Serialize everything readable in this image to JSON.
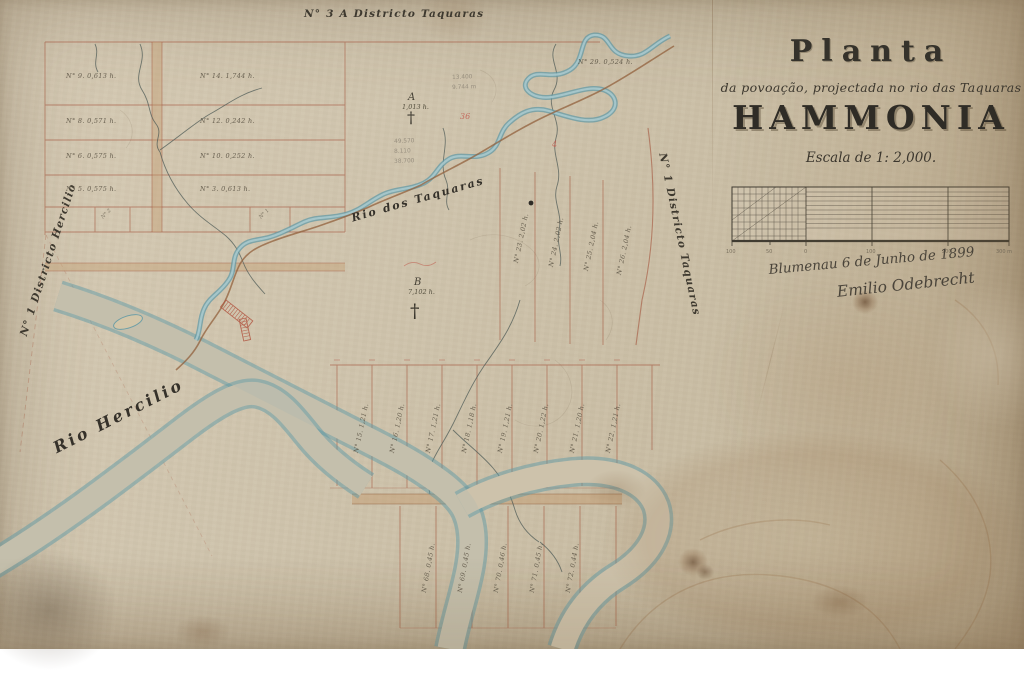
{
  "title_block": {
    "heading": "Planta",
    "subtitle": "da povoação, projectada no rio das Taquaras",
    "settlement_name": "HAMMONIA",
    "scale_label": "Escala de 1: 2,000.",
    "scale_ticks": [
      "100",
      "50",
      "0",
      "100",
      "200",
      "300 m"
    ],
    "signature_place_date": "Blumenau 6 de Junho de 1899",
    "signature_name": "Emilio Odebrecht"
  },
  "district_labels": {
    "top": "N° 3 A  Districto Taquaras",
    "left": "N° 1  Districto Hercilio",
    "right": "N° 1  Districto Taquaras"
  },
  "river_labels": {
    "taquaras": "Rio dos Taquaras",
    "hercilio": "Rio Hercilio"
  },
  "markers": {
    "a_letter": "A",
    "a_area": "1,013 h.",
    "a_cross": "†",
    "b_letter": "B",
    "b_area": "7,102 h.",
    "b_cross": "†",
    "red_note_1": "36",
    "red_note_2": "4"
  },
  "pencil_notes": {
    "n1": "13.400",
    "n2": "9.744 m",
    "n3": "49.570",
    "n4": "8.110",
    "n5": "38.700"
  },
  "lots": {
    "left_block": [
      "N° 9.  0,613 h.",
      "N° 14.  1,744 h.",
      "N° 8.  0,571 h.",
      "N° 12.  0,242 h.",
      "N° 6.  0,575 h.",
      "N° 10.  0,252 h.",
      "N° 5.  0,575 h.",
      "N° 3.  0,613 h.",
      "N° 2",
      "N° 1"
    ],
    "river_lot": "N° 29.  0,524 h.",
    "east_band": [
      "N° 23.  2,02 h.",
      "N° 24.  2,02 h.",
      "N° 25.  2,04 h.",
      "N° 26.  2,04 h."
    ],
    "mid_band": [
      "N° 15.  1,21 h.",
      "N° 16.  1,20 h.",
      "N° 17.  1,21 h.",
      "N° 18.  1,18 h.",
      "N° 19.  1,21 h.",
      "N° 20.  1,22 h.",
      "N° 21.  1,20 h.",
      "N° 22.  1,21 h."
    ],
    "south_band": [
      "N° 68.  0,45 h.",
      "N° 69.  0,45 h.",
      "N° 70.  0,46 h.",
      "N° 71.  0,45 h.",
      "N° 72.  0,44 h."
    ]
  }
}
